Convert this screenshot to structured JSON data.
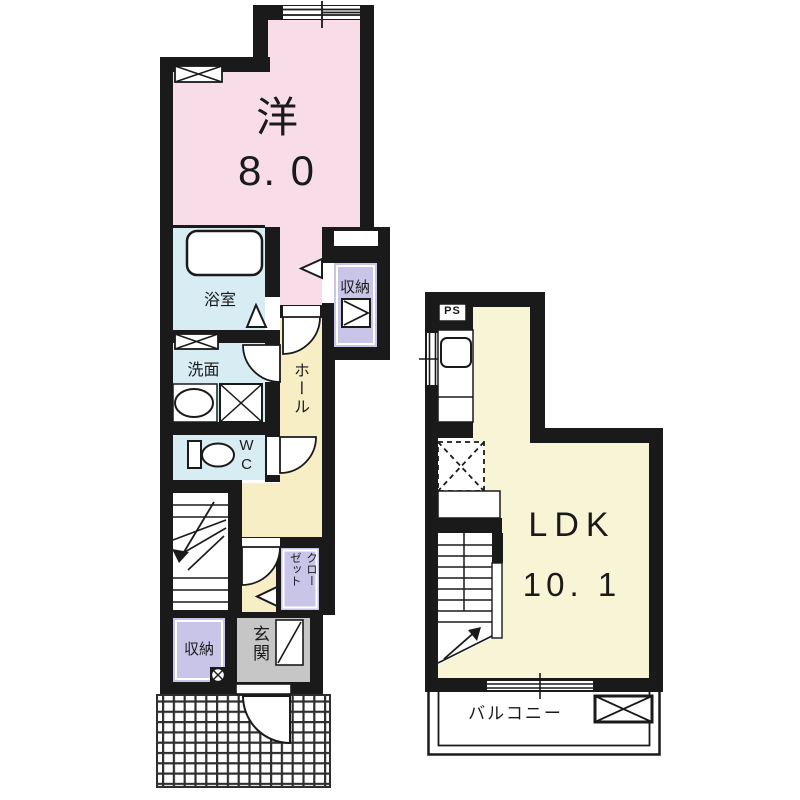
{
  "floor1": {
    "western_room": {
      "name_label": "洋",
      "area_label": "8. 0"
    },
    "bathroom_label": "浴室",
    "washroom_label": "洗面",
    "wc_label": "WC",
    "hall_label": "ホール",
    "storage_upper_label": "収納",
    "closet_label": "クローゼット",
    "entrance_label": "玄関",
    "storage_lower_label": "収納"
  },
  "floor2": {
    "pipe_space_label": "PS",
    "ldk": {
      "name_label": "LDK",
      "area_label": "10. 1"
    },
    "balcony_label": "バルコニー"
  },
  "colors": {
    "wall": "#1a1a1a",
    "western_room_fill": "#f8dde9",
    "wet_area_fill": "#d8ecf4",
    "storage_fill": "#c9c5e9",
    "hall_fill": "#f7eec6",
    "ldk_fill": "#f8f4d6",
    "entrance_fill": "#c6c6c6"
  }
}
